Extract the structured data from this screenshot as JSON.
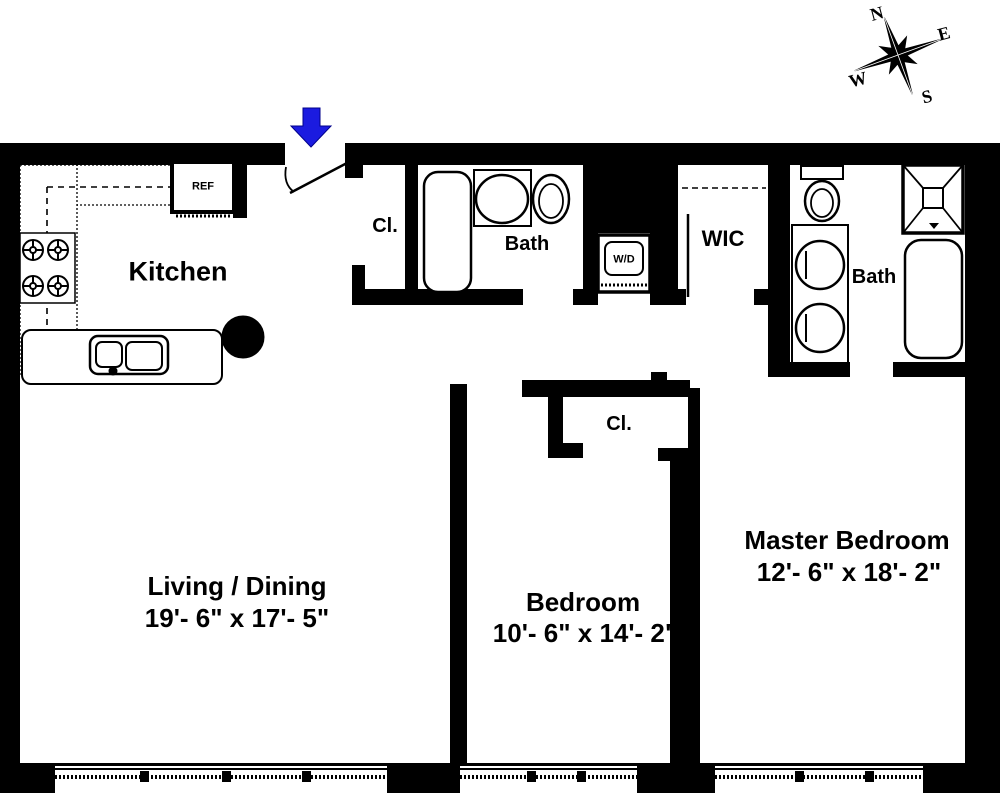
{
  "compass": {
    "n": "N",
    "e": "E",
    "s": "S",
    "w": "W"
  },
  "rooms": {
    "kitchen": {
      "label": "Kitchen"
    },
    "living": {
      "label": "Living / Dining",
      "dimensions": "19'- 6\" x 17'- 5\""
    },
    "bedroom": {
      "label": "Bedroom",
      "dimensions": "10'- 6\" x 14'- 2\""
    },
    "master_bedroom": {
      "label": "Master Bedroom",
      "dimensions": "12'- 6\" x 18'- 2\""
    },
    "bath1": {
      "label": "Bath"
    },
    "bath2": {
      "label": "Bath"
    },
    "wic": {
      "label": "WIC"
    },
    "entry_closet": {
      "label": "Cl."
    },
    "bedroom_closet": {
      "label": "Cl."
    }
  },
  "fixtures": {
    "refrigerator": "REF",
    "washer_dryer": "W/D"
  },
  "colors": {
    "walls": "#000000",
    "entry_arrow": "#1b1be0",
    "background": "#ffffff"
  }
}
